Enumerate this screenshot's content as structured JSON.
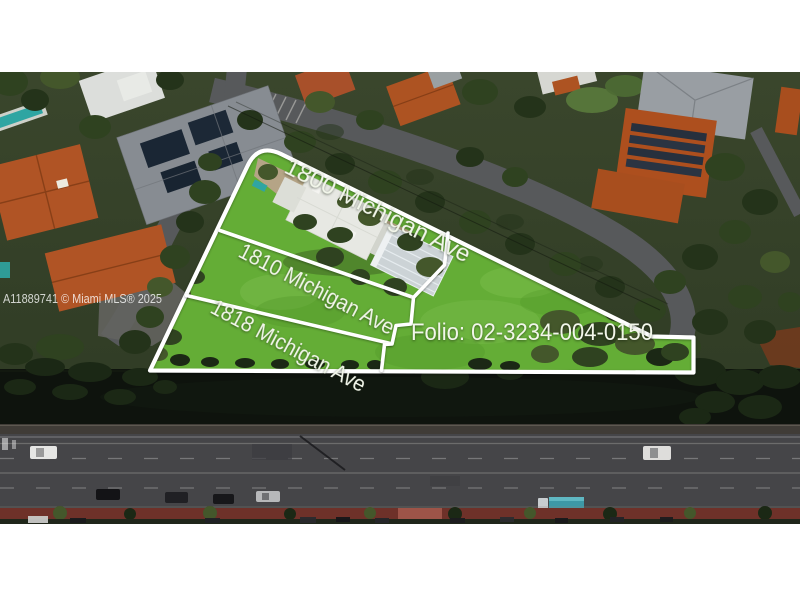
{
  "watermark": {
    "text": "A11889741 © Miami MLS® 2025"
  },
  "parcels": {
    "lot_1800": {
      "label": "1800 Michigan Ave"
    },
    "lot_1810": {
      "label": "1810 Michigan Ave"
    },
    "lot_1818": {
      "label": "1818 Michigan Ave"
    },
    "folio": {
      "label": "Folio: 02-3234-004-0150"
    }
  },
  "colors": {
    "outline": "#ffffff",
    "label-text": "#f2f6ea",
    "grass": "#64ad36",
    "grass-light": "#84c455",
    "grass-dark": "#4f9427",
    "canal": "#0e130d",
    "road": "#454548",
    "seawall": "#403c37",
    "sidewalk-red": "#6e3129",
    "dirt": "#b5a486",
    "roof-orange": "#b05425",
    "roof-gray": "#878c92",
    "tree-dark": "#24331a",
    "tree-mid": "#2f4220",
    "tree-olive": "#44572b",
    "street": "#57595b",
    "pool-teal": "#2fa5a2",
    "photo-frame": "#ffffff"
  }
}
